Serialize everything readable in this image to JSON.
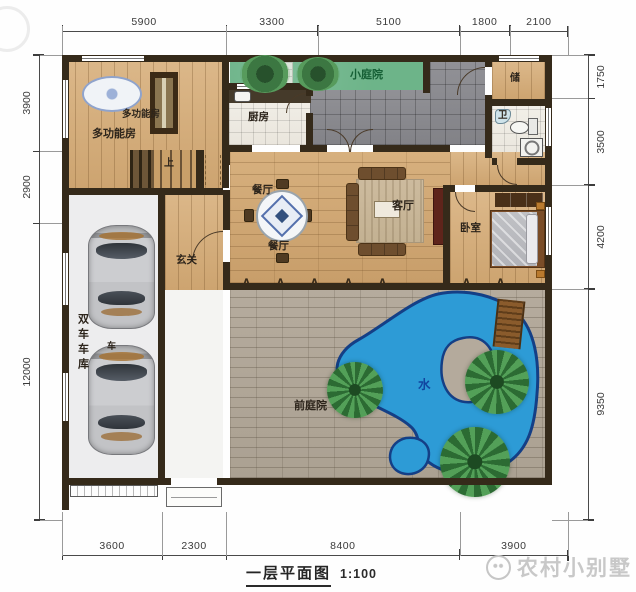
{
  "title": {
    "name": "一层平面图",
    "scale": "1:100"
  },
  "watermark": {
    "brand": "农村小别墅"
  },
  "dimensions": {
    "top": [
      "5900",
      "3300",
      "5100",
      "1800",
      "2100"
    ],
    "left": [
      "3900",
      "2900",
      "12000"
    ],
    "right": [
      "1750",
      "3500",
      "4200",
      "9350"
    ],
    "bottom": [
      "3600",
      "2300",
      "8400",
      "3900"
    ]
  },
  "labels": {
    "multifunction_room": "多功能房",
    "multifunction_room_2": "多功能房",
    "stairs_up": "上",
    "kitchen": "厨房",
    "small_courtyard": "小庭院",
    "storage": "储",
    "bathroom": "卫",
    "dining_a": "餐厅",
    "dining_b": "餐厅",
    "living_room": "客厅",
    "bedroom": "卧室",
    "foyer": "玄关",
    "garage_vertical": "双车车库",
    "garage_car": "车",
    "front_courtyard": "前庭院",
    "pond_water": "水"
  },
  "symbols": {
    "casement": "∧"
  },
  "colors": {
    "wall": "#352a1a",
    "wood_light": "#dcb88a",
    "wood_hall": "#d7b07e",
    "tile_white": "#f2efe8",
    "tile_gray": "#919196",
    "grass_green": "#6db489",
    "brick_gray": "#b5ab9d",
    "pond_blue": "#2d9bd6",
    "pond_outline": "#143f86",
    "courtyard_text_green": "#155f35",
    "water_text_blue": "#1145a0",
    "label_dark": "#2c241b",
    "dim_text": "#3a3a3a",
    "watermark_gray": "#c8c8c8"
  }
}
